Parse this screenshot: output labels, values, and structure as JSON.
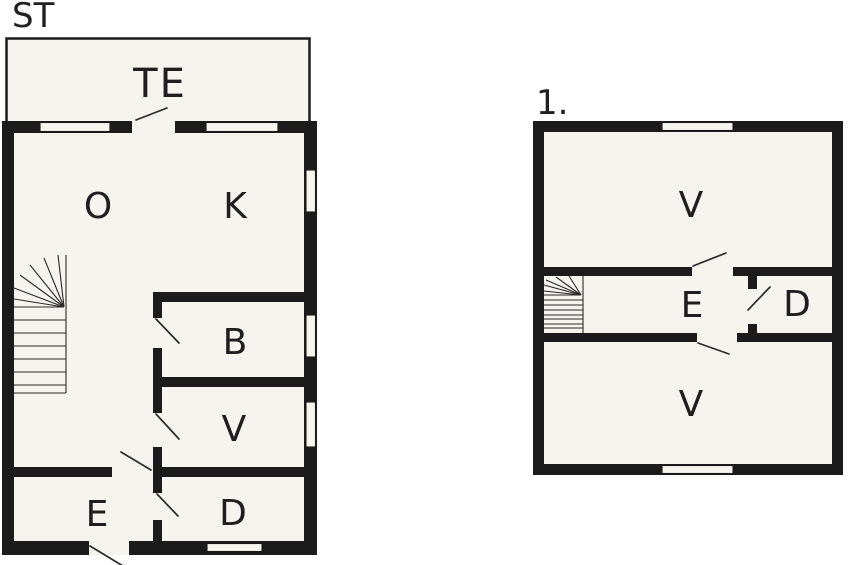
{
  "palette": {
    "page": "#ffffff",
    "floor": "#f5f4ef",
    "wall": "#1b1b1b",
    "line": "#2a2a2a",
    "label": "#1f1f1f"
  },
  "plans": [
    {
      "id": "ground-floor",
      "label": "ST",
      "rooms": [
        {
          "id": "terrace",
          "label": "TE"
        },
        {
          "id": "living-room",
          "label": "O"
        },
        {
          "id": "kitchen",
          "label": "K"
        },
        {
          "id": "bathroom",
          "label": "B"
        },
        {
          "id": "wc",
          "label": "V"
        },
        {
          "id": "entry",
          "label": "E"
        },
        {
          "id": "room-d",
          "label": "D"
        }
      ]
    },
    {
      "id": "first-floor",
      "label": "1.",
      "rooms": [
        {
          "id": "bedroom-upper",
          "label": "V"
        },
        {
          "id": "landing",
          "label": "E"
        },
        {
          "id": "closet",
          "label": "D"
        },
        {
          "id": "bedroom-lower",
          "label": "V"
        }
      ]
    }
  ]
}
